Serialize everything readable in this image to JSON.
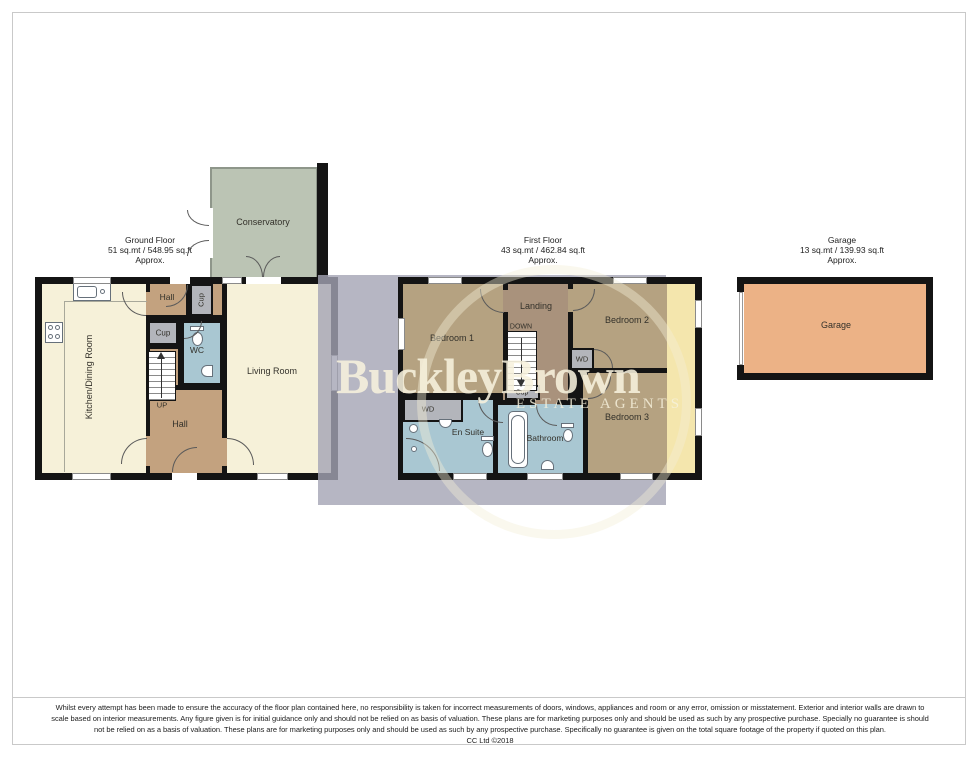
{
  "ground_floor": {
    "title": "Ground Floor",
    "area": "51 sq.mt / 548.95 sq.ft",
    "approx": "Approx.",
    "labels": {
      "conservatory": "Conservatory",
      "kitchen": "Kitchen/Dining Room",
      "hall_top": "Hall",
      "cup_top": "Cup",
      "cup_mid": "Cup",
      "wc": "WC",
      "up": "UP",
      "hall": "Hall",
      "living": "Living Room"
    }
  },
  "first_floor": {
    "title": "First Floor",
    "area": "43 sq.mt / 462.84 sq.ft",
    "approx": "Approx.",
    "labels": {
      "bedroom1": "Bedroom 1",
      "landing": "Landing",
      "down": "DOWN",
      "bedroom2": "Bedroom 2",
      "wd_right": "WD",
      "cup": "Cup",
      "wd_left": "WD",
      "ensuite": "En Suite",
      "bathroom": "Bathroom",
      "bedroom3": "Bedroom 3"
    }
  },
  "garage": {
    "title": "Garage",
    "area": "13 sq.mt / 139.93 sq.ft",
    "approx": "Approx.",
    "labels": {
      "garage": "Garage"
    }
  },
  "watermark": {
    "brand": "BuckleyBrown",
    "tagline": "ESTATE AGENTS"
  },
  "footer": {
    "lines": [
      "Whilst every attempt has been made to ensure the accuracy of the floor plan contained here, no responsibility is taken for incorrect measurements of doors, windows, appliances and room or any error, omission or misstatement. Exterior and interior walls are drawn to",
      "scale based on interior measurements. Any figure given is for initial guidance only and should not be relied on as basis of valuation. These plans are for marketing purposes only and should be used as such by any prospective purchase. Specially no guarantee is should",
      "not be relied on as a basis of valuation. These plans are for marketing purposes only and should be used as such by any prospective purchase. Specifically no guarantee is given on the total square footage of the property if quoted on this plan.",
      "CC Ltd ©2018"
    ]
  },
  "colors": {
    "wall": "#141414",
    "cream_room": "#f6f1d9",
    "hall_tan": "#c3a27f",
    "bedroom_taupe": "#b5a281",
    "landing_brown": "#a9927c",
    "bathroom_blue": "#a9c7d2",
    "closet_gray": "#b3b5bb",
    "conservatory_sage": "#bbc4b4",
    "side_strip_yellow": "#f4e6ad",
    "garage_orange": "#ecb286",
    "watermark_gray": "#b4b4c0",
    "watermark_cream": "#f7f1dd"
  }
}
